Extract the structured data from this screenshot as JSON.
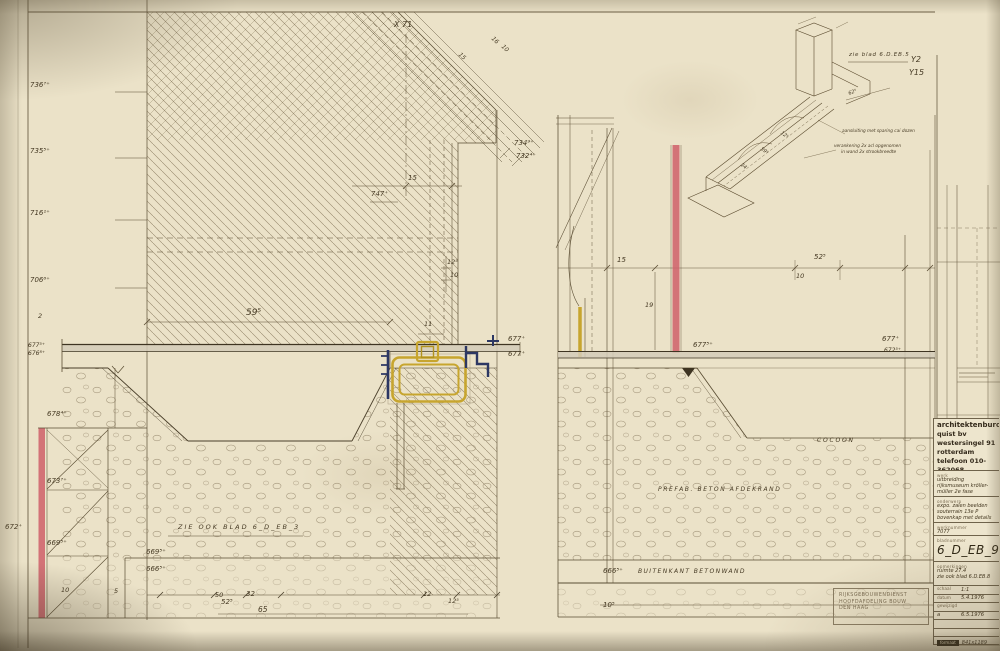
{
  "title_block": {
    "firm": {
      "name": "architektenburo",
      "line2": "quist bv",
      "address": "westersingel 91",
      "city": "rotterdam",
      "phone": "telefoon 010-362068"
    },
    "werk_label": "werk",
    "werk": "uitbreiding rijksmuseum kröller-müller 2e fase",
    "onderwerp_label": "onderwerp",
    "onderwerp": "expo. zalen beelden souterrain 13e P bovenkap met details",
    "werknummer_label": "werknummer",
    "werknummer": "7077",
    "bladnummer_label": "bladnummer",
    "bladnummer": "6_D_EB_9",
    "opmerkingen_label": "opmerkingen",
    "opmerkingen1": "ruimte 27.4",
    "opmerkingen2": "zie ook blad 6.D.EB.8",
    "schaal_label": "schaal",
    "schaal": "1:1",
    "datum_label": "datum",
    "datum": "5.4.1976",
    "gewijzigd_label": "gewijzigd",
    "gewijzigd_index": "a",
    "gewijzigd_date": "6.5.1976",
    "formaat_label": "formaat",
    "formaat": "841x1189"
  },
  "stamp": {
    "line1": "RIJKSGEBOUWENDIENST",
    "line2": "HOOFDAFDELING BOUW",
    "line3": "DEN HAAG"
  },
  "colors": {
    "paper": "#ebe2c8",
    "ink": "#463a24",
    "red_marker": "#cf5f68",
    "yellow_marker": "#c7a52e",
    "navy_marker": "#2c3763"
  },
  "texts": [
    {
      "t": "736⁷⁺",
      "x": 30,
      "y": 82,
      "n": "elevation-label"
    },
    {
      "t": "735⁵⁺",
      "x": 30,
      "y": 148,
      "n": "elevation-label"
    },
    {
      "t": "716¹⁺",
      "x": 30,
      "y": 210,
      "n": "elevation-label"
    },
    {
      "t": "706⁶⁺",
      "x": 30,
      "y": 277,
      "n": "elevation-label"
    },
    {
      "t": "677⁵⁺",
      "x": 28,
      "y": 343,
      "s": 6,
      "n": "elevation-label"
    },
    {
      "t": "676⁸⁺",
      "x": 28,
      "y": 351,
      "s": 6,
      "n": "elevation-label"
    },
    {
      "t": "678⁴⁺",
      "x": 47,
      "y": 411,
      "n": "elevation-label"
    },
    {
      "t": "673⁷⁺",
      "x": 47,
      "y": 478,
      "n": "elevation-label"
    },
    {
      "t": "669⁵⁺",
      "x": 47,
      "y": 540,
      "n": "elevation-label"
    },
    {
      "t": "672⁺",
      "x": 5,
      "y": 524,
      "n": "elevation-label"
    },
    {
      "t": "2",
      "x": 38,
      "y": 313,
      "s": 6.5,
      "n": "dim-label"
    },
    {
      "t": "X 71",
      "x": 394,
      "y": 21,
      "s": 8,
      "n": "grid-ref-x"
    },
    {
      "t": "Y2",
      "x": 911,
      "y": 56,
      "s": 8,
      "n": "grid-ref-y"
    },
    {
      "t": "Y15",
      "x": 909,
      "y": 69,
      "s": 8,
      "n": "grid-ref-y"
    },
    {
      "t": "15",
      "x": 461,
      "y": 52,
      "s": 6,
      "r": 45,
      "n": "dim-label"
    },
    {
      "t": "16",
      "x": 494,
      "y": 36,
      "s": 6,
      "r": 45,
      "n": "dim-label"
    },
    {
      "t": "10",
      "x": 504,
      "y": 44,
      "s": 6,
      "r": 45,
      "n": "dim-label"
    },
    {
      "t": "15",
      "x": 408,
      "y": 175,
      "n": "dim-label"
    },
    {
      "t": "747⁺",
      "x": 371,
      "y": 191,
      "n": "elevation-label"
    },
    {
      "t": "12⁵",
      "x": 447,
      "y": 259,
      "s": 6.5,
      "n": "dim-label"
    },
    {
      "t": "10",
      "x": 450,
      "y": 272,
      "s": 6.5,
      "n": "dim-label"
    },
    {
      "t": "59⁵",
      "x": 246,
      "y": 309,
      "s": 9,
      "n": "dim-label"
    },
    {
      "t": "11",
      "x": 424,
      "y": 321,
      "s": 6.5,
      "n": "dim-label"
    },
    {
      "t": "677⁺",
      "x": 508,
      "y": 336,
      "n": "elevation-label"
    },
    {
      "t": "677⁺",
      "x": 508,
      "y": 351,
      "n": "elevation-label"
    },
    {
      "t": "669⁵⁺",
      "x": 146,
      "y": 549,
      "n": "elevation-label"
    },
    {
      "t": "666⁵⁺",
      "x": 146,
      "y": 566,
      "n": "elevation-label"
    },
    {
      "t": "10",
      "x": 61,
      "y": 587,
      "s": 6.5,
      "n": "dim-label"
    },
    {
      "t": "5",
      "x": 114,
      "y": 588,
      "s": 6.5,
      "n": "dim-label"
    },
    {
      "t": "50",
      "x": 215,
      "y": 592,
      "s": 6.5,
      "n": "dim-label"
    },
    {
      "t": "32",
      "x": 246,
      "y": 591,
      "s": 7,
      "n": "dim-label"
    },
    {
      "t": "52⁵",
      "x": 221,
      "y": 599,
      "s": 7,
      "n": "dim-label"
    },
    {
      "t": "65",
      "x": 258,
      "y": 606,
      "s": 7.5,
      "n": "dim-label"
    },
    {
      "t": "12",
      "x": 423,
      "y": 591,
      "s": 6.5,
      "n": "dim-label"
    },
    {
      "t": "12⁵",
      "x": 448,
      "y": 598,
      "s": 6.5,
      "n": "dim-label"
    },
    {
      "t": "734⁹⁺",
      "x": 514,
      "y": 140,
      "n": "elevation-label"
    },
    {
      "t": "732⁴⁺",
      "x": 516,
      "y": 153,
      "n": "elevation-label"
    },
    {
      "t": "15",
      "x": 617,
      "y": 257,
      "n": "dim-label"
    },
    {
      "t": "52⁵",
      "x": 814,
      "y": 254,
      "n": "dim-label"
    },
    {
      "t": "10",
      "x": 796,
      "y": 273,
      "s": 6.5,
      "n": "dim-label"
    },
    {
      "t": "19",
      "x": 645,
      "y": 302,
      "s": 6.5,
      "n": "dim-label"
    },
    {
      "t": "677⁵⁺",
      "x": 693,
      "y": 342,
      "n": "elevation-label"
    },
    {
      "t": "677⁺",
      "x": 882,
      "y": 336,
      "n": "elevation-label"
    },
    {
      "t": "672⁵⁺",
      "x": 884,
      "y": 348,
      "s": 6,
      "n": "elevation-label"
    },
    {
      "t": "666⁵⁺",
      "x": 603,
      "y": 568,
      "n": "elevation-label"
    },
    {
      "t": "10⁵",
      "x": 603,
      "y": 602,
      "n": "dim-label"
    },
    {
      "t": "ZIE OOK BLAD 6_D_EB_3",
      "x": 178,
      "y": 524,
      "s": 6.5,
      "ls": 2,
      "n": "sheet-ref-note"
    },
    {
      "t": "PREFAB. BETON AFDEKRAND",
      "x": 658,
      "y": 487,
      "s": 6,
      "ls": 1.6,
      "n": "material-note"
    },
    {
      "t": "BUITENKANT BETONWAND",
      "x": 638,
      "y": 569,
      "s": 6,
      "ls": 1.4,
      "n": "material-note"
    },
    {
      "t": "COCOON",
      "x": 817,
      "y": 438,
      "s": 6,
      "ls": 1.8,
      "n": "cocoon-label"
    },
    {
      "t": "zie blad 6.D.EB.5",
      "x": 849,
      "y": 53,
      "s": 5.5,
      "ls": 0.8,
      "n": "sheet-ref-note"
    },
    {
      "t": "aansluiting met sparing cai dozen",
      "x": 842,
      "y": 130,
      "s": 4.3,
      "n": "axon-note"
    },
    {
      "t": "verankering 2x acl opgenomen",
      "x": 834,
      "y": 145,
      "s": 4.3,
      "n": "axon-note"
    },
    {
      "t": "in wand 2x strookbreedte",
      "x": 841,
      "y": 151,
      "s": 4.3,
      "n": "axon-note"
    },
    {
      "t": "24",
      "x": 742,
      "y": 163,
      "s": 5,
      "r": 37,
      "n": "dim-label"
    },
    {
      "t": "59⁵",
      "x": 762,
      "y": 147,
      "s": 5,
      "r": 37,
      "n": "dim-label"
    },
    {
      "t": "12⁵",
      "x": 782,
      "y": 131,
      "s": 5,
      "r": 37,
      "n": "dim-label"
    },
    {
      "t": "62⁵",
      "x": 848,
      "y": 92,
      "s": 5,
      "r": -20,
      "n": "dim-label"
    }
  ]
}
